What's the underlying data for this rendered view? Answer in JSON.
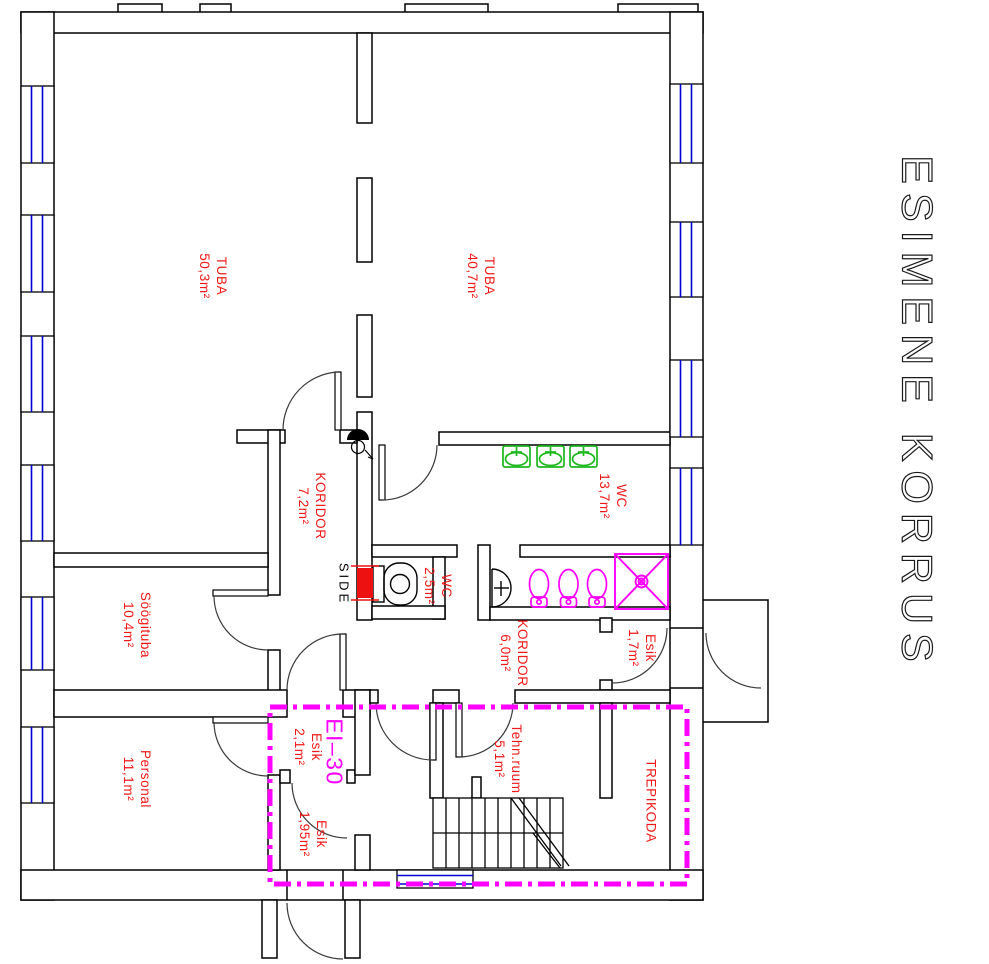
{
  "drawing": {
    "title": "ESIMENE KORRUS",
    "fire_rating_label": "EI–30",
    "side_label": "SIDE"
  },
  "rooms": [
    {
      "name": "TUBA",
      "area": "50,3m²"
    },
    {
      "name": "TUBA",
      "area": "40,7m²"
    },
    {
      "name": "KORIDOR",
      "area": "7,2m²"
    },
    {
      "name": "WC",
      "area": "13,7m²"
    },
    {
      "name": "WC",
      "area": "2,5m²"
    },
    {
      "name": "Söögituba",
      "area": "10,4m²"
    },
    {
      "name": "KORIDOR",
      "area": "6,0m²"
    },
    {
      "name": "Esik",
      "area": "1,7m²"
    },
    {
      "name": "Personal",
      "area": "11,1m²"
    },
    {
      "name": "Esik",
      "area": "2,1m²"
    },
    {
      "name": "Esik",
      "area": "1,95m²"
    },
    {
      "name": "Tehn.ruum",
      "area": "5,1m²"
    },
    {
      "name": "TREPIKODA",
      "area": ""
    }
  ],
  "colors": {
    "wall": "#000000",
    "room_label": "#f01818",
    "fire_boundary": "#ff00ff",
    "window": "#0000d0",
    "green_fixture": "#1cb81c",
    "pink_fixture": "#ff00ff",
    "side_marker": "#ee1111"
  }
}
